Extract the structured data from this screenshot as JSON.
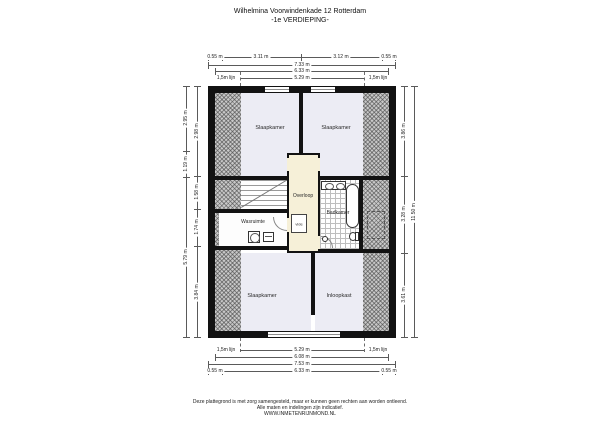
{
  "title": {
    "line1": "Wilhelmina Voorwindenkade 12 Rotterdam",
    "line2": "-1e VERDIEPING-"
  },
  "rooms": {
    "bedroom_top_left": "Slaapkamer",
    "bedroom_top_right": "Slaapkamer",
    "landing": "Overloop",
    "void": "vide",
    "laundry": "Wasruimte",
    "bathroom": "Badkamer",
    "bedroom_bottom": "Slaapkamer",
    "closet": "Inloopkast"
  },
  "dimensions": {
    "top": {
      "segments": [
        "0.55 m",
        "3.11 m",
        "3.12 m",
        "0.55 m"
      ],
      "total": "7.33 m",
      "inner": "6.33 m",
      "line15_left": "1,5m lijn",
      "line15_span": "5.29 m",
      "line15_right": "1,5m lijn"
    },
    "bottom": {
      "line15_left": "1,5m lijn",
      "line15_span": "5.29 m",
      "line15_right": "1,5m lijn",
      "inner": "6.08 m",
      "total": "7.53 m",
      "segments": [
        "0.55 m",
        "6.33 m",
        "0.55 m"
      ]
    },
    "left_outer": [
      "2.95 m",
      "1.19 m",
      "5.79 m"
    ],
    "left_inner": [
      "2.98 m",
      "1.58 m",
      "1.74 m",
      "3.84 m"
    ],
    "right_inner": [
      "3.86 m",
      "3.28 m",
      "3.61 m"
    ],
    "right_total": "11.50 m"
  },
  "footer": {
    "line1": "Deze plattegrond is met zorg samengesteld, maar er kunnen geen rechten aan worden ontleend.",
    "line2": "Alle maten en indelingen zijn indicatief.",
    "line3": "WWW.INMETENRIJNMOND.NL"
  },
  "colors": {
    "wall": "#121212",
    "room_floor": "#ececf4",
    "landing_floor": "#f6f0d8",
    "hatch": "#c9c9c9",
    "dimension_line": "#5a5a5a"
  }
}
